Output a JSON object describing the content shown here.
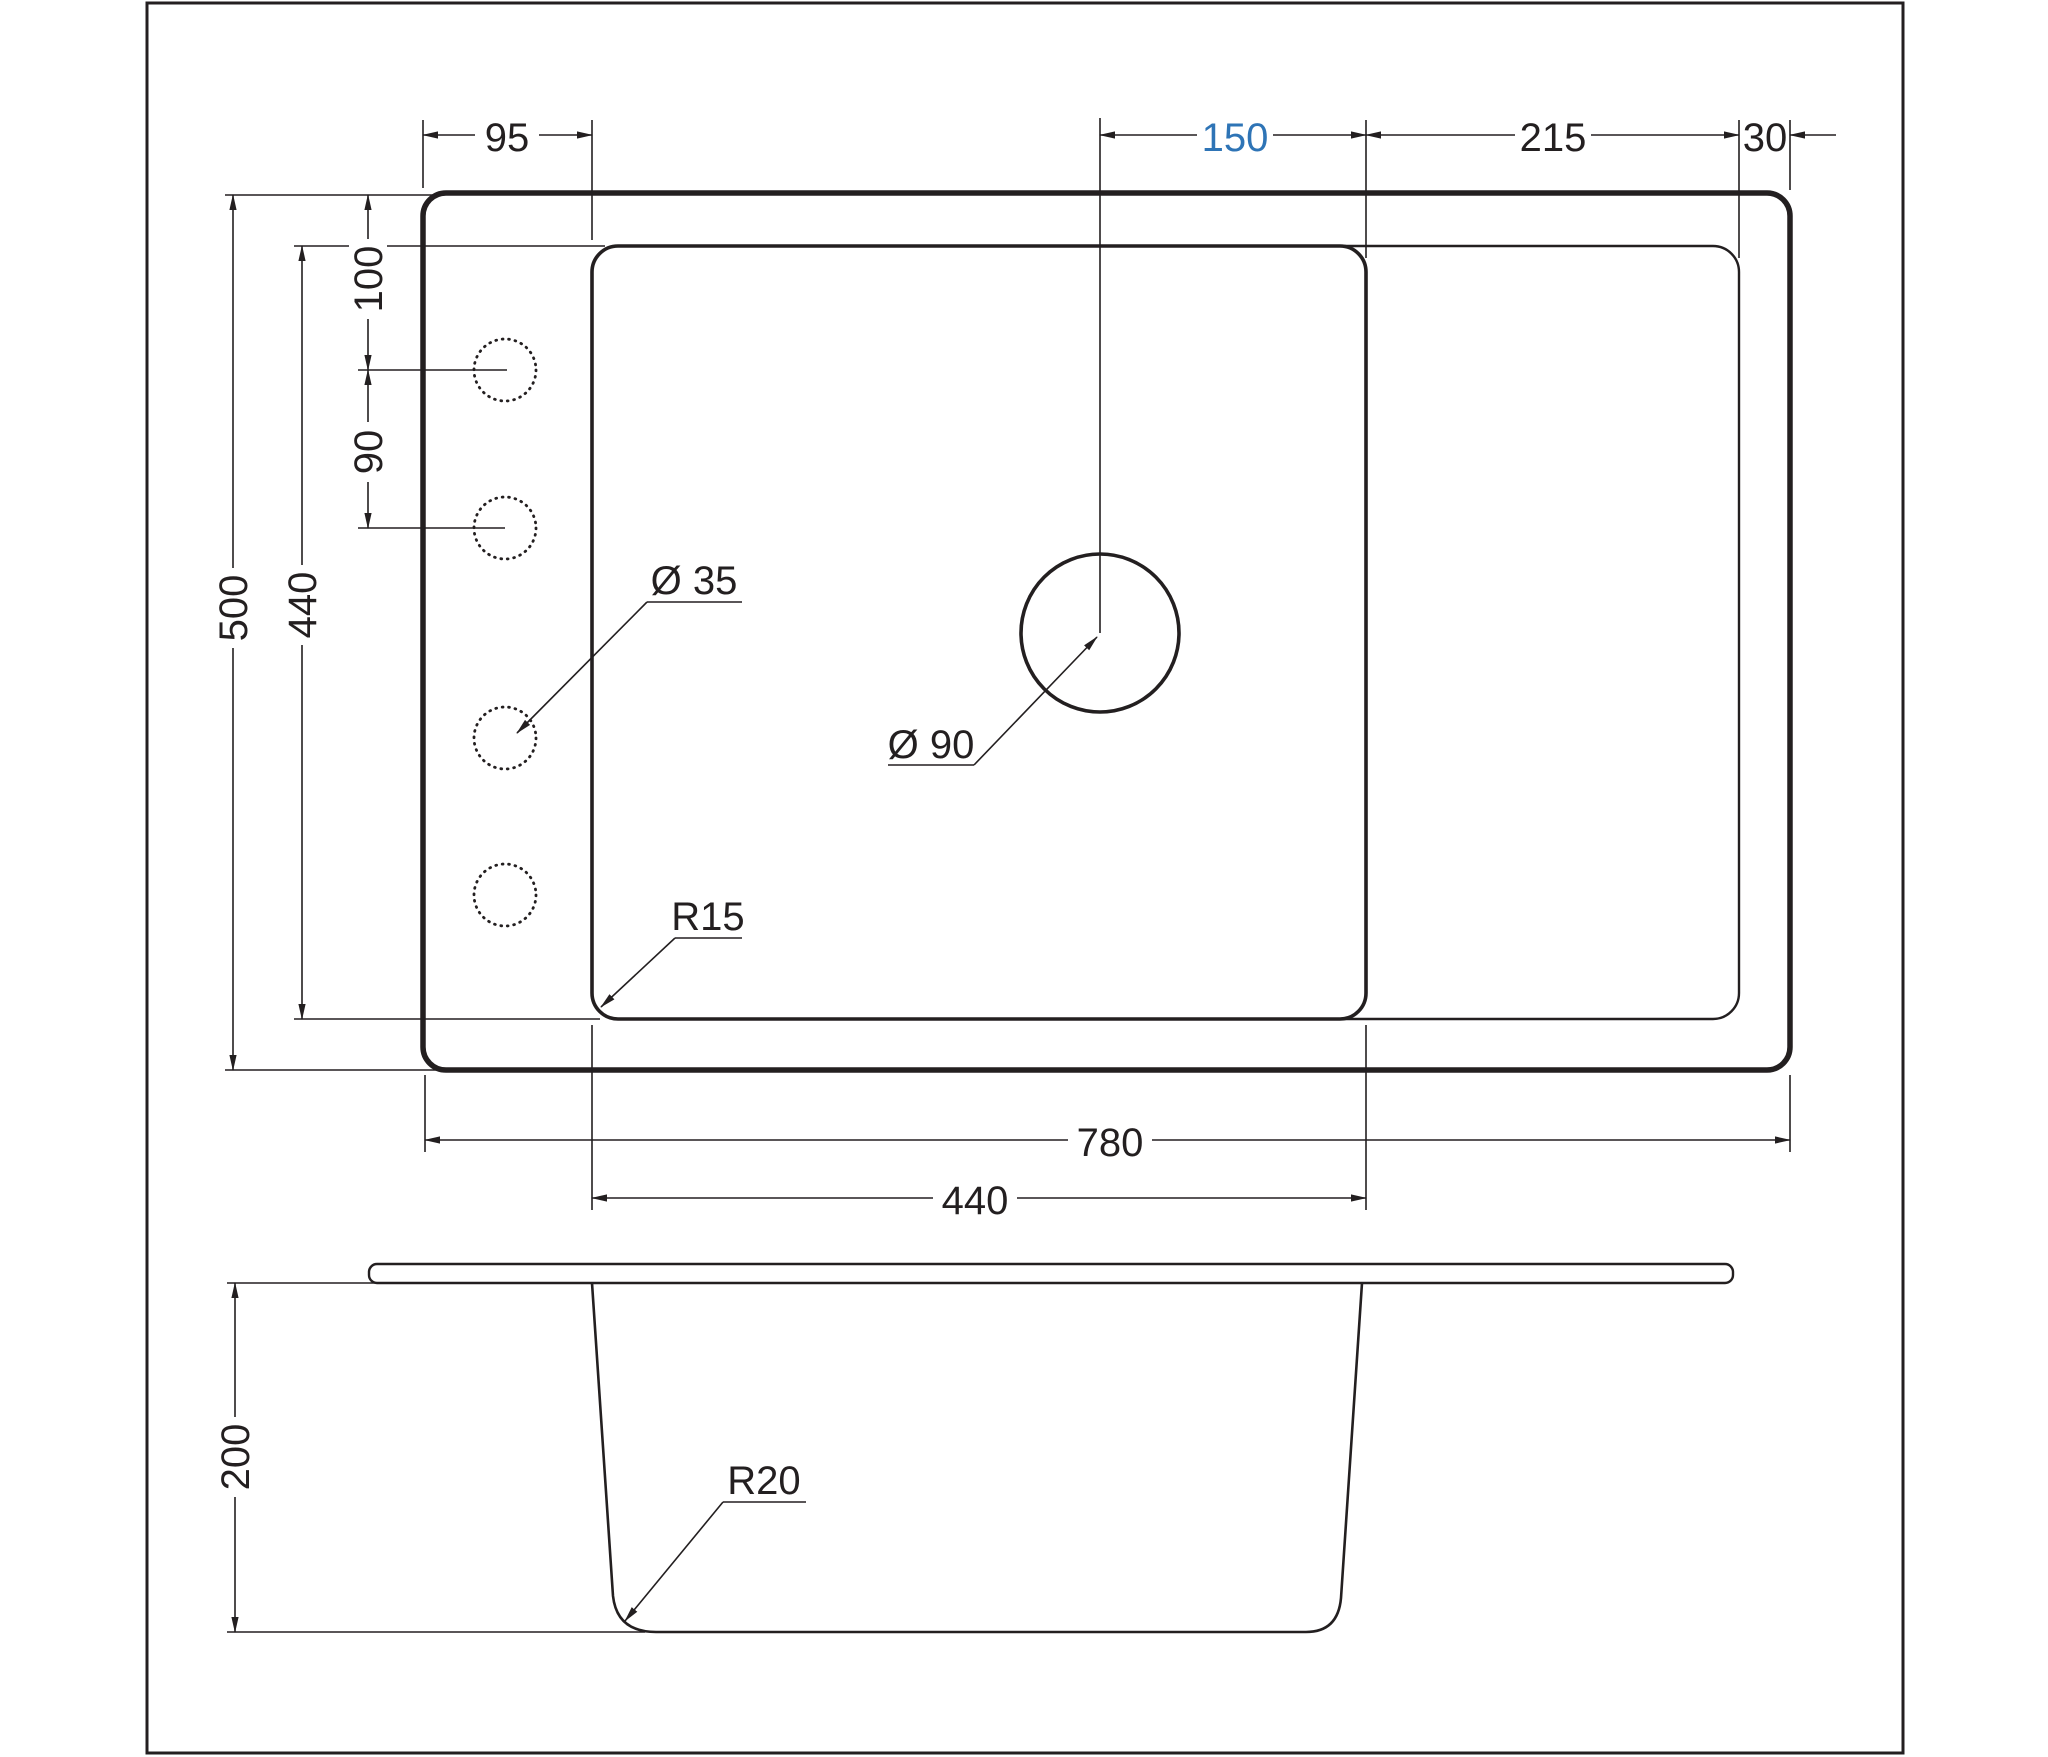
{
  "drawing": {
    "type": "technical-drawing",
    "subject": "kitchen sink top view and section view",
    "colors": {
      "line": "#231f20",
      "accent_dimension": "#2e74b6",
      "background": "#ffffff"
    },
    "dims": {
      "d95": "95",
      "d150": "150",
      "d215": "215",
      "d30": "30",
      "d100": "100",
      "d90": "90",
      "d500": "500",
      "d440_left": "440",
      "d780": "780",
      "d440_bottom": "440",
      "d200": "200"
    },
    "annotations": {
      "dia35": "Ø 35",
      "dia90": "Ø 90",
      "r15": "R15",
      "r20": "R20"
    }
  }
}
